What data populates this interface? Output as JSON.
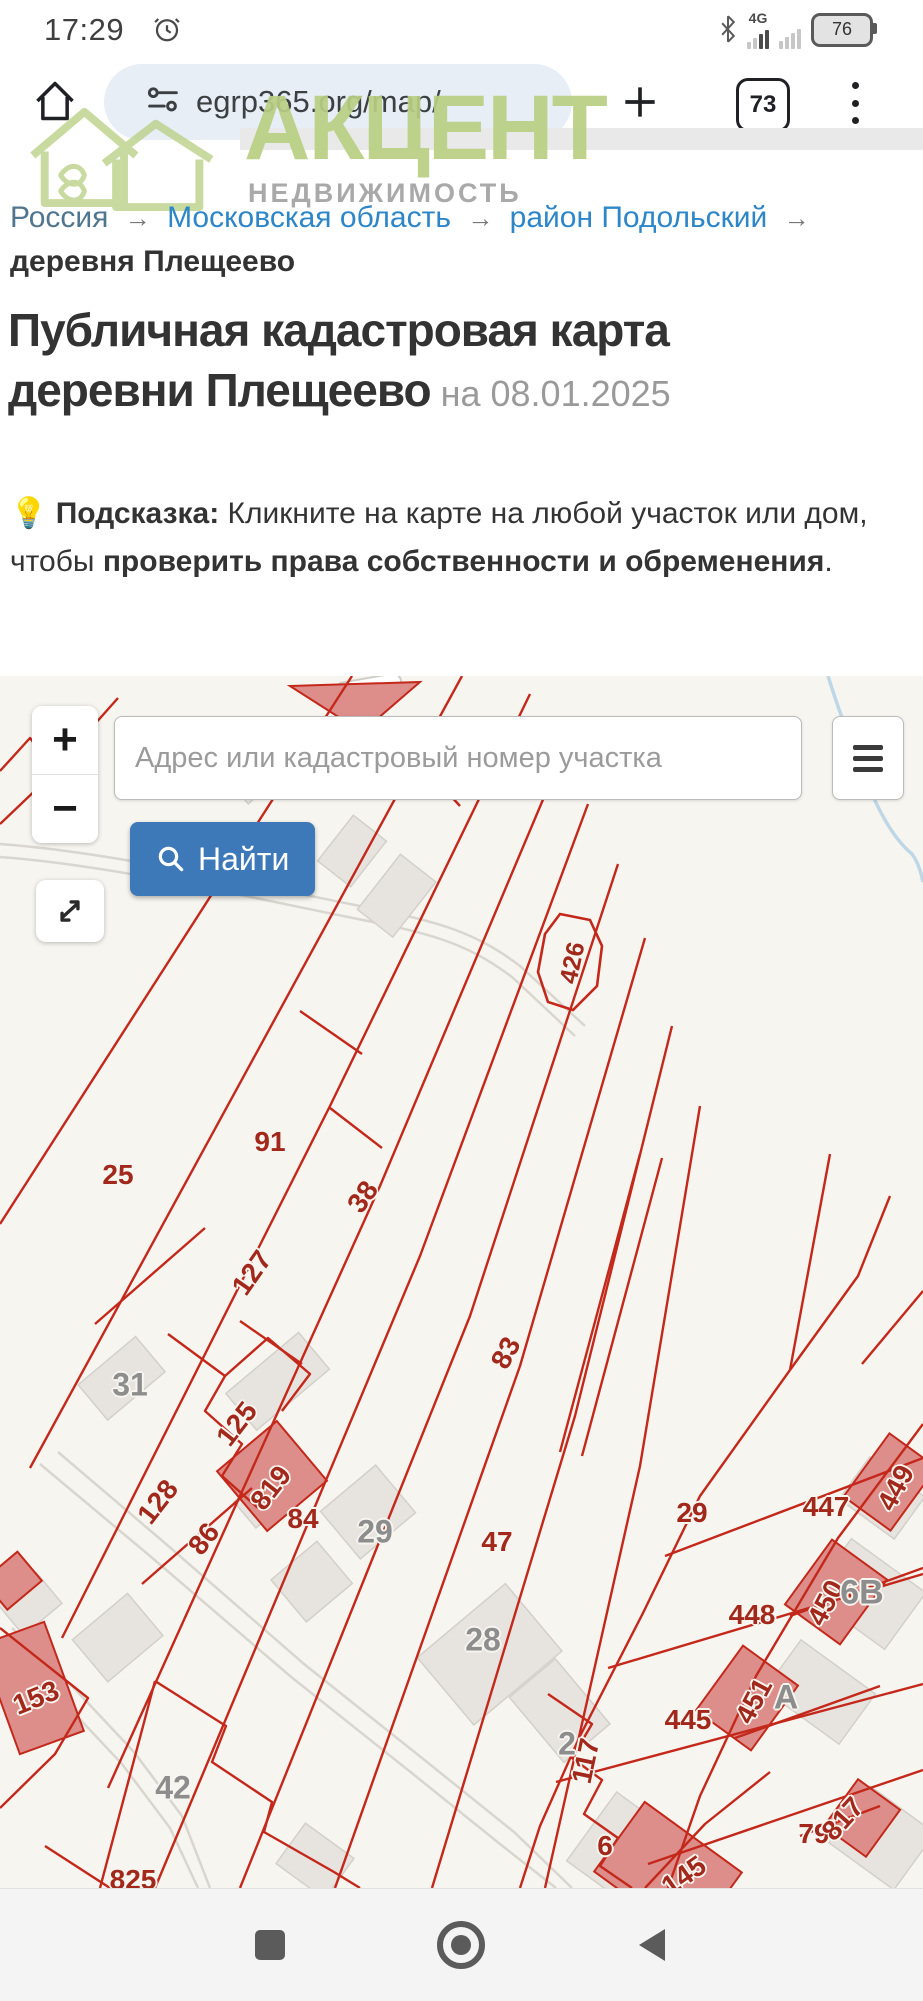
{
  "status_bar": {
    "time": "17:29",
    "network_label": "4G",
    "battery_percent": "76"
  },
  "browser": {
    "url": "egrp365.org/map/",
    "tab_count": "73"
  },
  "logo": {
    "name": "АКЦЕНТ",
    "tagline": "НЕДВИЖИМОСТЬ"
  },
  "breadcrumb": {
    "separator": "→",
    "items": [
      {
        "label": "Россия"
      },
      {
        "label": "Московская область"
      },
      {
        "label": "район Подольский"
      },
      {
        "label": "деревня Плещеево"
      }
    ]
  },
  "article": {
    "title_line1": "Публичная кадастровая карта",
    "title_line2": "деревни Плещеево",
    "title_date": " на 08.01.2025",
    "tip_icon": "💡",
    "tip_label": "Подсказка:",
    "tip_text": " Кликните на карте на любой участок или дом, чтобы ",
    "tip_bold": "проверить права собственности и обременения",
    "tip_period": "."
  },
  "map_ui": {
    "zoom_in": "+",
    "zoom_out": "−",
    "search_placeholder": "Адрес или кадастровый номер участка",
    "find_button": "Найти"
  },
  "map_labels": [
    {
      "text": "426",
      "x": 573,
      "y": 287,
      "rot": -78,
      "color": "red",
      "size": 25
    },
    {
      "text": "25",
      "x": 118,
      "y": 499,
      "rot": 0,
      "color": "red",
      "size": 28
    },
    {
      "text": "91",
      "x": 270,
      "y": 466,
      "rot": 0,
      "color": "red",
      "size": 28
    },
    {
      "text": "38",
      "x": 363,
      "y": 521,
      "rot": -55,
      "color": "red",
      "size": 28
    },
    {
      "text": "127",
      "x": 252,
      "y": 597,
      "rot": -55,
      "color": "red",
      "size": 28
    },
    {
      "text": "31",
      "x": 130,
      "y": 709,
      "rot": 0,
      "color": "gray",
      "size": 32
    },
    {
      "text": "125",
      "x": 237,
      "y": 748,
      "rot": -52,
      "color": "red",
      "size": 28
    },
    {
      "text": "128",
      "x": 158,
      "y": 826,
      "rot": -52,
      "color": "red",
      "size": 28
    },
    {
      "text": "86",
      "x": 204,
      "y": 863,
      "rot": -52,
      "color": "red",
      "size": 28
    },
    {
      "text": "819",
      "x": 271,
      "y": 812,
      "rot": -52,
      "color": "red",
      "size": 28
    },
    {
      "text": "84",
      "x": 303,
      "y": 843,
      "rot": 0,
      "color": "red",
      "size": 28
    },
    {
      "text": "29",
      "x": 375,
      "y": 856,
      "rot": 0,
      "color": "gray",
      "size": 32
    },
    {
      "text": "83",
      "x": 506,
      "y": 677,
      "rot": -62,
      "color": "red",
      "size": 28
    },
    {
      "text": "47",
      "x": 497,
      "y": 866,
      "rot": 0,
      "color": "red",
      "size": 28
    },
    {
      "text": "28",
      "x": 483,
      "y": 964,
      "rot": 0,
      "color": "gray",
      "size": 32
    },
    {
      "text": "29",
      "x": 692,
      "y": 837,
      "rot": 0,
      "color": "red",
      "size": 28
    },
    {
      "text": "447",
      "x": 826,
      "y": 831,
      "rot": 0,
      "color": "red",
      "size": 28
    },
    {
      "text": "449",
      "x": 896,
      "y": 812,
      "rot": -62,
      "color": "red",
      "size": 28
    },
    {
      "text": "448",
      "x": 752,
      "y": 939,
      "rot": 0,
      "color": "red",
      "size": 28
    },
    {
      "text": "450",
      "x": 826,
      "y": 927,
      "rot": -62,
      "color": "red",
      "size": 28
    },
    {
      "text": "6В",
      "x": 862,
      "y": 917,
      "rot": 0,
      "color": "gray",
      "size": 34
    },
    {
      "text": "451",
      "x": 754,
      "y": 1025,
      "rot": -62,
      "color": "red",
      "size": 28
    },
    {
      "text": "А",
      "x": 786,
      "y": 1022,
      "rot": 0,
      "color": "gray",
      "size": 34
    },
    {
      "text": "445",
      "x": 688,
      "y": 1044,
      "rot": 0,
      "color": "red",
      "size": 28
    },
    {
      "text": "117",
      "x": 586,
      "y": 1085,
      "rot": -78,
      "color": "red",
      "size": 28
    },
    {
      "text": "2",
      "x": 567,
      "y": 1068,
      "rot": 0,
      "color": "gray",
      "size": 32
    },
    {
      "text": "6",
      "x": 605,
      "y": 1170,
      "rot": 0,
      "color": "red",
      "size": 28
    },
    {
      "text": "145",
      "x": 684,
      "y": 1200,
      "rot": -35,
      "color": "red",
      "size": 28
    },
    {
      "text": "79",
      "x": 814,
      "y": 1158,
      "rot": 0,
      "color": "red",
      "size": 28
    },
    {
      "text": "817",
      "x": 843,
      "y": 1143,
      "rot": -48,
      "color": "red",
      "size": 28
    },
    {
      "text": "153",
      "x": 36,
      "y": 1022,
      "rot": -22,
      "color": "red",
      "size": 28
    },
    {
      "text": "42",
      "x": 173,
      "y": 1112,
      "rot": 0,
      "color": "gray",
      "size": 32
    },
    {
      "text": "825",
      "x": 133,
      "y": 1204,
      "rot": 0,
      "color": "red",
      "size": 28
    }
  ],
  "colors": {
    "accent_blue": "#3d79b8",
    "link_blue": "#2d86c8",
    "logo_green": "#b9cf83",
    "parcel_red": "#c4281b",
    "parcel_label_red": "#a1281a",
    "building_label_gray": "#8d8d8d",
    "map_bg": "#f7f5ef",
    "pink_building": "#dd8e8a",
    "gray_building": "#e7e4df",
    "river_blue": "#b7d4e6"
  }
}
